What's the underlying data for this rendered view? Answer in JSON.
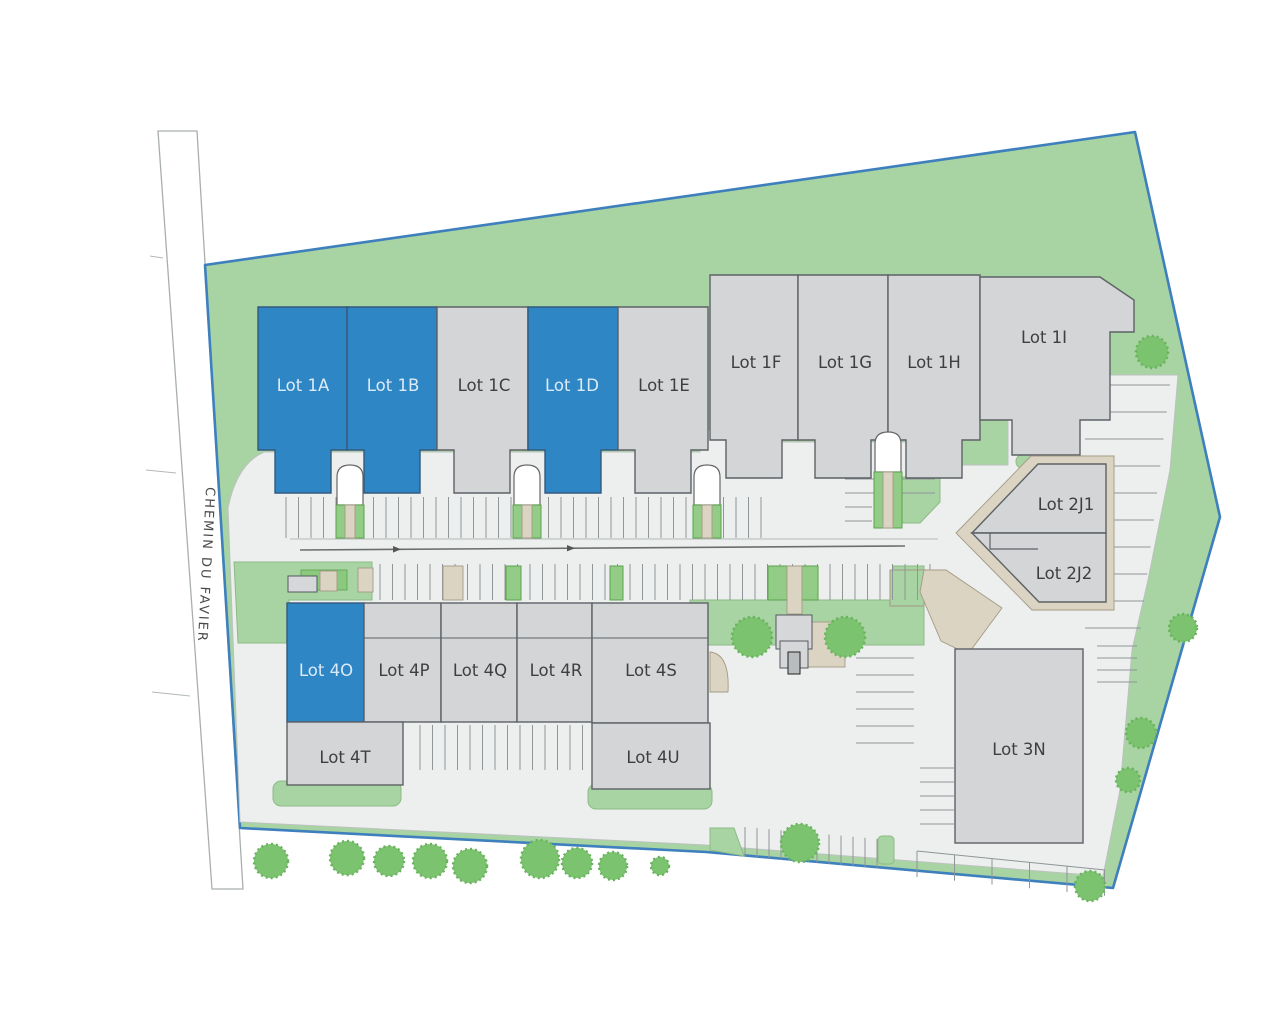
{
  "road_label": "CHEMIN DU FAVIER",
  "lots": {
    "1a": {
      "label": "Lot 1A",
      "highlighted": true
    },
    "1b": {
      "label": "Lot 1B",
      "highlighted": true
    },
    "1c": {
      "label": "Lot 1C",
      "highlighted": false
    },
    "1d": {
      "label": "Lot 1D",
      "highlighted": true
    },
    "1e": {
      "label": "Lot 1E",
      "highlighted": false
    },
    "1f": {
      "label": "Lot 1F",
      "highlighted": false
    },
    "1g": {
      "label": "Lot 1G",
      "highlighted": false
    },
    "1h": {
      "label": "Lot 1H",
      "highlighted": false
    },
    "1i": {
      "label": "Lot 1I",
      "highlighted": false
    },
    "2j1": {
      "label": "Lot 2J1",
      "highlighted": false
    },
    "2j2": {
      "label": "Lot 2J2",
      "highlighted": false
    },
    "3n": {
      "label": "Lot 3N",
      "highlighted": false
    },
    "4o": {
      "label": "Lot 4O",
      "highlighted": true
    },
    "4p": {
      "label": "Lot 4P",
      "highlighted": false
    },
    "4q": {
      "label": "Lot 4Q",
      "highlighted": false
    },
    "4r": {
      "label": "Lot 4R",
      "highlighted": false
    },
    "4s": {
      "label": "Lot 4S",
      "highlighted": false
    },
    "4t": {
      "label": "Lot 4T",
      "highlighted": false
    },
    "4u": {
      "label": "Lot 4U",
      "highlighted": false
    }
  },
  "colors": {
    "highlighted_lot": "#2f86c5",
    "standard_lot": "#d3d5d7",
    "greenspace": "#a8d3a2",
    "tree": "#7cc36f",
    "boundary": "#3e7fbe",
    "pavement": "#ecefee",
    "walkway": "#dcd4c2"
  }
}
